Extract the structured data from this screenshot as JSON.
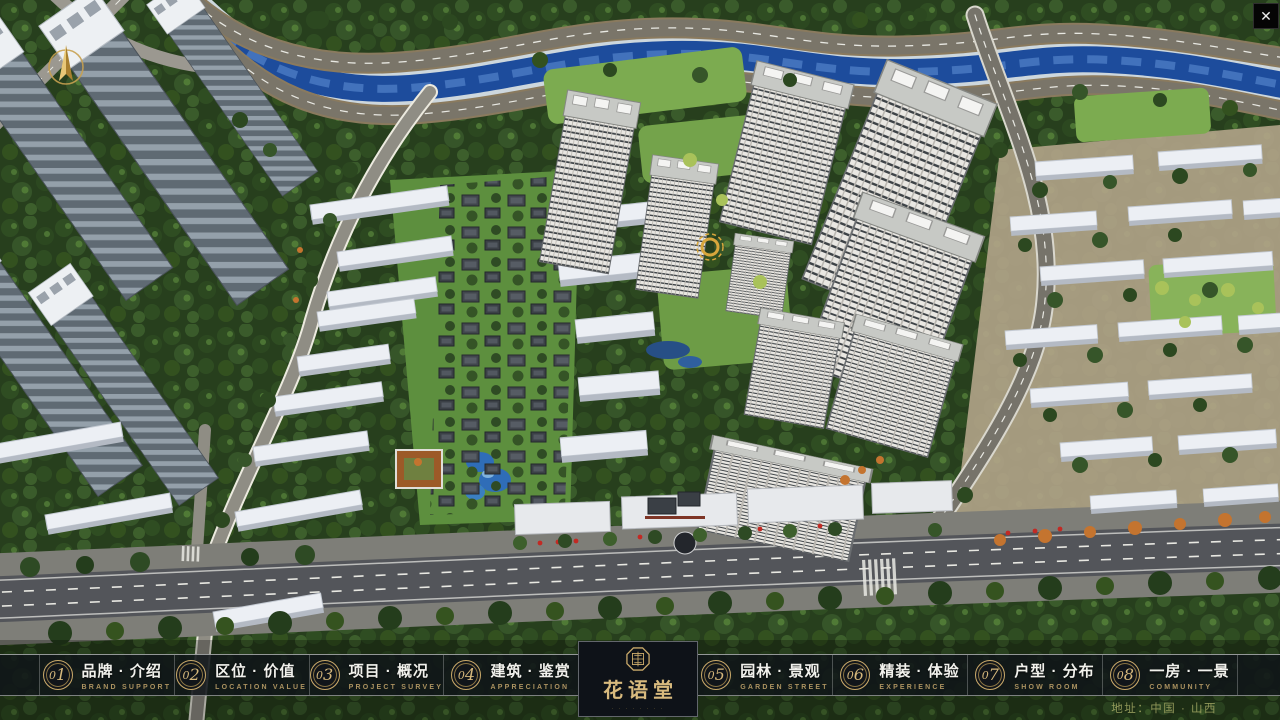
{
  "window": {
    "close_icon": "✕"
  },
  "nav": {
    "items": [
      {
        "num0": "0",
        "num1": "1",
        "zh": "品牌 · 介绍",
        "en": "BRAND SUPPORT"
      },
      {
        "num0": "0",
        "num1": "2",
        "zh": "区位 · 价值",
        "en": "LOCATION VALUE"
      },
      {
        "num0": "0",
        "num1": "3",
        "zh": "项目 · 概况",
        "en": "PROJECT SURVEY"
      },
      {
        "num0": "0",
        "num1": "4",
        "zh": "建筑 · 鉴赏",
        "en": "APPRECIATION"
      },
      {
        "num0": "0",
        "num1": "5",
        "zh": "园林 · 景观",
        "en": "GARDEN STREET"
      },
      {
        "num0": "0",
        "num1": "6",
        "zh": "精装 · 体验",
        "en": "EXPERIENCE"
      },
      {
        "num0": "0",
        "num1": "7",
        "zh": "户型 · 分布",
        "en": "SHOW ROOM"
      },
      {
        "num0": "0",
        "num1": "8",
        "zh": "一房 · 一景",
        "en": "COMMUNITY"
      }
    ]
  },
  "logo": {
    "title": "花语堂",
    "caption": "· · · · · · · ·"
  },
  "footer": {
    "address": "地址：中国 · 山西"
  },
  "colors": {
    "gold_accent": "#c9a96a",
    "bar_background": "#10141 9",
    "river_blue": "#1d4c9c",
    "forest_green": "#273f1d",
    "tower_white": "#e9e7e2",
    "accent_red": "#c22a24"
  }
}
